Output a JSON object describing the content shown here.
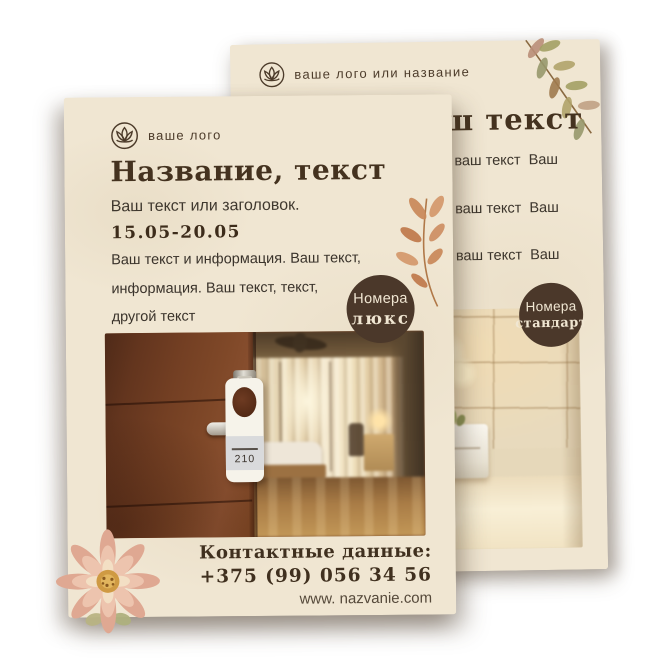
{
  "front_flyer": {
    "logo_label": "ваше лого",
    "title": "Название, текст",
    "subtitle": "Ваш текст или заголовок.",
    "date_range": "15.05-20.05",
    "body_lines": [
      "Ваш текст и информация. Ваш текст,",
      "информация. Ваш текст, текст,",
      "другой текст"
    ],
    "badge": {
      "line1": "Номера",
      "line2": "люкс"
    },
    "door_tag_number": "210",
    "contacts": {
      "heading": "Контактные данные:",
      "phone": "+375 (99) 056 34 56",
      "website": "www. nazvanie.com"
    }
  },
  "back_flyer": {
    "logo_label": "ваше лого или название",
    "title_visible": "ш текст",
    "lines": [
      "т ваш текст  Ваш",
      "т ваш текст  Ваш",
      "т ваш текст  Ваш"
    ],
    "badge": {
      "line1": "Номера",
      "line2": "стандарт"
    }
  },
  "icons": {
    "front_logo": "lotus-flower-in-circle",
    "back_logo": "lotus-flower-in-circle",
    "decor_front": "terracotta-leaf-branch",
    "decor_back": "watercolor-olive-branch",
    "decor_flower": "watercolor-dahlia-flower"
  },
  "colors": {
    "paper": "#f0e6d2",
    "ink_dark_brown": "#44321f",
    "body_text": "#3a332b",
    "badge_brown": "#4b382a",
    "badge_text": "#f0e6d2",
    "leaf_terracotta": "#c98a5c",
    "leaf_olive": "#a3a064",
    "flower_pink": "#dfa892",
    "background": "#ffffff"
  }
}
